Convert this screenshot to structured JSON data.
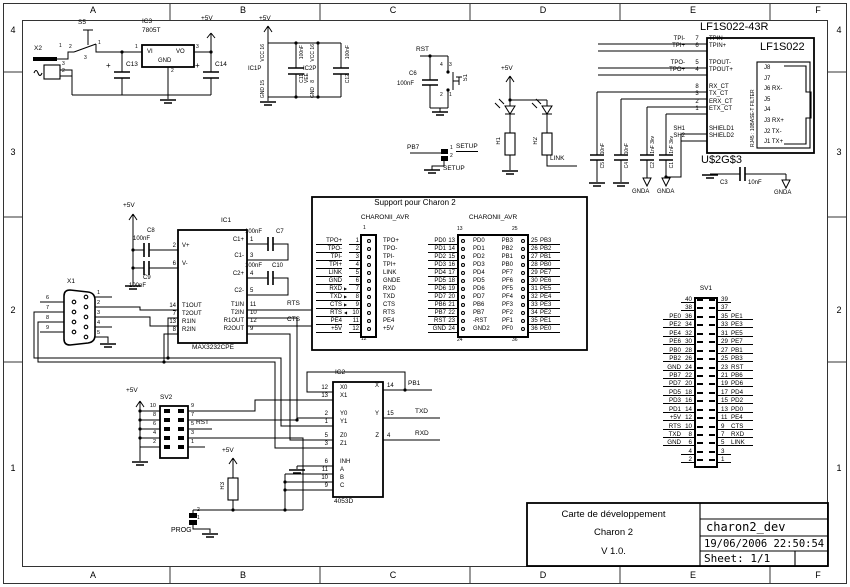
{
  "frame": {
    "cols": [
      "A",
      "B",
      "C",
      "D",
      "E",
      "F"
    ],
    "rows": [
      "4",
      "3",
      "2",
      "1"
    ]
  },
  "common": {
    "plus5": "+5V",
    "nf": "100nF",
    "gnda": "GNDA",
    "avr": "CHARONII_AVR",
    "plus": "+"
  },
  "power": {
    "x2": "X2",
    "p1": "1",
    "p3": "3",
    "p2": "2",
    "s5": "S5",
    "s2": "2",
    "s1": "1",
    "s3": "3",
    "ic3": "IC3",
    "part": "7805T",
    "vi": "VI",
    "vo": "VO",
    "gnd": "GND",
    "pin_in": "1",
    "pin_out": "3",
    "pin_gnd": "2",
    "c13": "C13",
    "c14": "C14"
  },
  "decap": {
    "ic1p": "IC1P",
    "ic2p": "IC2P",
    "c11": "C11",
    "c12": "C12",
    "vcc": "VCC",
    "gnd": "GND",
    "vee": "VEE",
    "p16": "16",
    "p15": "15",
    "p8": "8"
  },
  "rst": {
    "net": "RST",
    "c6": "C6",
    "s1": "S1",
    "p4": "4",
    "p3": "3",
    "p2": "2",
    "p1": "1"
  },
  "setup": {
    "pb7": "PB7",
    "label": "SETUP",
    "p1": "1",
    "p2": "2"
  },
  "leds": {
    "r1": "R1",
    "r2": "R2",
    "link": "LINK"
  },
  "eth": {
    "title": "LF1S022-43R",
    "part": "LF1S022",
    "name": "U$2G$3",
    "rj45": "RJ45 : 10BASE-T FILTER",
    "pins": [
      {
        "net": "TPI-",
        "pin": "7",
        "name": "TPIN-"
      },
      {
        "net": "TPI+",
        "pin": "6",
        "name": "TPIN+"
      },
      {
        "net": "TPO-",
        "pin": "5",
        "name": "TPOUT-"
      },
      {
        "net": "TPO+",
        "pin": "4",
        "name": "TPOUT+"
      },
      {
        "net": "",
        "pin": "8",
        "name": "RX_CT"
      },
      {
        "net": "",
        "pin": "3",
        "name": "TX_CT"
      },
      {
        "net": "",
        "pin": "2",
        "name": "ERX_CT"
      },
      {
        "net": "",
        "pin": "1",
        "name": "ETX_CT"
      },
      {
        "net": "SH1",
        "pin": "",
        "name": "SHIELD1"
      },
      {
        "net": "SH2",
        "pin": "",
        "name": "SHIELD2"
      }
    ],
    "jack": [
      "J8",
      "J7",
      "J6 RX-",
      "J5",
      "J4",
      "J3 RX+",
      "J2 TX-",
      "J1 TX+"
    ],
    "caps": [
      {
        "ref": "C5",
        "val": "10nF"
      },
      {
        "ref": "C4",
        "val": "10nF"
      },
      {
        "ref": "C2",
        "val": "1nF 3kv"
      },
      {
        "ref": "C1",
        "val": "1nF 3kv"
      }
    ],
    "c3": "C3",
    "c3val": "10nF"
  },
  "ic1": {
    "ref": "IC1",
    "part": "MAX3232CPE",
    "left": [
      {
        "pin": "2",
        "name": "V+"
      },
      {
        "pin": "6",
        "name": "V-"
      },
      {
        "pin": "14",
        "name": "T1OUT"
      },
      {
        "pin": "7",
        "name": "T2OUT"
      },
      {
        "pin": "13",
        "name": "R1IN"
      },
      {
        "pin": "8",
        "name": "R2IN"
      }
    ],
    "right": [
      {
        "pin": "1",
        "name": "C1+"
      },
      {
        "pin": "3",
        "name": "C1-"
      },
      {
        "pin": "4",
        "name": "C2+"
      },
      {
        "pin": "5",
        "name": "C2-"
      },
      {
        "pin": "11",
        "name": "T1IN"
      },
      {
        "pin": "10",
        "name": "T2IN"
      },
      {
        "pin": "12",
        "name": "R1OUT"
      },
      {
        "pin": "9",
        "name": "R2OUT"
      }
    ],
    "c7": "C7",
    "c8": "C8",
    "c9": "C9",
    "c10": "C10",
    "rts": "RTS",
    "cts": "CTS"
  },
  "x1": {
    "ref": "X1",
    "rpins": [
      "1",
      "2",
      "3",
      "4",
      "5"
    ],
    "lpins": [
      "6",
      "7",
      "8",
      "9"
    ]
  },
  "support": {
    "title": "Support pour Charon 2",
    "a_top": "1",
    "a_bot": "12",
    "b_tl": "13",
    "b_bl": "24",
    "b_tr": "25",
    "b_br": "36",
    "a_rows": [
      {
        "net": "TPO+",
        "arr": "",
        "pin": "1",
        "name": "TPO+"
      },
      {
        "net": "TPO-",
        "arr": "",
        "pin": "2",
        "name": "TPO-"
      },
      {
        "net": "TPI-",
        "arr": "",
        "pin": "3",
        "name": "TPI-"
      },
      {
        "net": "TPI+",
        "arr": "",
        "pin": "4",
        "name": "TPI+"
      },
      {
        "net": "LINK",
        "arr": "",
        "pin": "5",
        "name": "LINK"
      },
      {
        "net": "GND",
        "arr": "",
        "pin": "6",
        "name": "GNDE"
      },
      {
        "net": "RXD",
        "arr": "▶",
        "pin": "7",
        "name": "RXD"
      },
      {
        "net": "TXD",
        "arr": "▶",
        "pin": "8",
        "name": "TXD"
      },
      {
        "net": "CTS",
        "arr": "▶",
        "pin": "9",
        "name": "CTS"
      },
      {
        "net": "RTS",
        "arr": "◀",
        "pin": "10",
        "name": "RTS"
      },
      {
        "net": "PE4",
        "arr": "",
        "pin": "11",
        "name": "PE4"
      },
      {
        "net": "+5V",
        "arr": "",
        "pin": "12",
        "name": "+5V"
      }
    ],
    "b_rows": [
      {
        "lnet": "PD0",
        "lpin": "13",
        "lname": "PD0",
        "rname": "PB3",
        "rpin": "25",
        "rnet": "PB3"
      },
      {
        "lnet": "PD1",
        "lpin": "14",
        "lname": "PD1",
        "rname": "PB2",
        "rpin": "26",
        "rnet": "PB2"
      },
      {
        "lnet": "PD2",
        "lpin": "15",
        "lname": "PD2",
        "rname": "PB1",
        "rpin": "27",
        "rnet": "PB1"
      },
      {
        "lnet": "PD3",
        "lpin": "16",
        "lname": "PD3",
        "rname": "PB0",
        "rpin": "28",
        "rnet": "PB0"
      },
      {
        "lnet": "PD4",
        "lpin": "17",
        "lname": "PD4",
        "rname": "PF7",
        "rpin": "29",
        "rnet": "PE7"
      },
      {
        "lnet": "PD5",
        "lpin": "18",
        "lname": "PD5",
        "rname": "PF6",
        "rpin": "30",
        "rnet": "PE6"
      },
      {
        "lnet": "PD6",
        "lpin": "19",
        "lname": "PD6",
        "rname": "PF5",
        "rpin": "31",
        "rnet": "PE5"
      },
      {
        "lnet": "PD7",
        "lpin": "20",
        "lname": "PD7",
        "rname": "PF4",
        "rpin": "32",
        "rnet": "PE4"
      },
      {
        "lnet": "PB6",
        "lpin": "21",
        "lname": "PB6",
        "rname": "PF3",
        "rpin": "33",
        "rnet": "PE3"
      },
      {
        "lnet": "PB7",
        "lpin": "22",
        "lname": "PB7",
        "rname": "PF2",
        "rpin": "34",
        "rnet": "PE2"
      },
      {
        "lnet": "RST",
        "lpin": "23",
        "lname": "-RST",
        "rname": "PF1",
        "rpin": "35",
        "rnet": "PE1"
      },
      {
        "lnet": "GND",
        "lpin": "24",
        "lname": "GND2",
        "rname": "PF0",
        "rpin": "36",
        "rnet": "PE0"
      }
    ]
  },
  "sv1": {
    "title": "SV1",
    "rows": [
      {
        "ln": "",
        "lp": "40",
        "rp": "39",
        "rn": ""
      },
      {
        "ln": "",
        "lp": "38",
        "rp": "37",
        "rn": ""
      },
      {
        "ln": "PE0",
        "lp": "36",
        "rp": "35",
        "rn": "PE1"
      },
      {
        "ln": "PE2",
        "lp": "34",
        "rp": "33",
        "rn": "PE3"
      },
      {
        "ln": "PE4",
        "lp": "32",
        "rp": "31",
        "rn": "PE5"
      },
      {
        "ln": "PE6",
        "lp": "30",
        "rp": "29",
        "rn": "PE7"
      },
      {
        "ln": "PB0",
        "lp": "28",
        "rp": "27",
        "rn": "PB1"
      },
      {
        "ln": "PB2",
        "lp": "26",
        "rp": "25",
        "rn": "PB3"
      },
      {
        "ln": "GND",
        "lp": "24",
        "rp": "23",
        "rn": "RST"
      },
      {
        "ln": "PB7",
        "lp": "22",
        "rp": "21",
        "rn": "PB6"
      },
      {
        "ln": "PD7",
        "lp": "20",
        "rp": "19",
        "rn": "PD6"
      },
      {
        "ln": "PD5",
        "lp": "18",
        "rp": "17",
        "rn": "PD4"
      },
      {
        "ln": "PD3",
        "lp": "16",
        "rp": "15",
        "rn": "PD2"
      },
      {
        "ln": "PD1",
        "lp": "14",
        "rp": "13",
        "rn": "PD0"
      },
      {
        "ln": "+5V",
        "lp": "12",
        "rp": "11",
        "rn": "PE4"
      },
      {
        "ln": "RTS",
        "lp": "10",
        "rp": "9",
        "rn": "CTS"
      },
      {
        "ln": "TXD",
        "lp": "8",
        "rp": "7",
        "rn": "RXD"
      },
      {
        "ln": "GND",
        "lp": "6",
        "rp": "5",
        "rn": "LINK"
      },
      {
        "ln": "",
        "lp": "4",
        "rp": "3",
        "rn": ""
      },
      {
        "ln": "",
        "lp": "2",
        "rp": "1",
        "rn": ""
      }
    ]
  },
  "ic2": {
    "ref": "IC2",
    "part": "4053D",
    "left": [
      {
        "pin": "12",
        "name": "X0"
      },
      {
        "pin": "13",
        "name": "X1"
      },
      {
        "pin": "2",
        "name": "Y0"
      },
      {
        "pin": "1",
        "name": "Y1"
      },
      {
        "pin": "5",
        "name": "Z0"
      },
      {
        "pin": "3",
        "name": "Z1"
      },
      {
        "pin": "6",
        "name": "INH"
      },
      {
        "pin": "11",
        "name": "A"
      },
      {
        "pin": "10",
        "name": "B"
      },
      {
        "pin": "9",
        "name": "C"
      }
    ],
    "right": [
      {
        "pin": "14",
        "name": "X",
        "net": "PB1"
      },
      {
        "pin": "15",
        "name": "Y",
        "net": "TXD"
      },
      {
        "pin": "4",
        "name": "Z",
        "net": "RXD"
      }
    ]
  },
  "sv2": {
    "title": "SV2",
    "lpins": [
      "10",
      "8",
      "6",
      "4",
      "2"
    ],
    "rpins": [
      "9",
      "7",
      "5",
      "3",
      "1"
    ],
    "rst": "RST"
  },
  "prog": {
    "r3": "R3",
    "label": "PROG",
    "p2": "2",
    "p1": "1"
  },
  "tb": {
    "l1": "Carte de développement",
    "l2": "Charon 2",
    "l3": "V 1.0.",
    "name": "charon2_dev",
    "date": "19/06/2006 22:50:54",
    "sheet": "Sheet: 1/1"
  }
}
